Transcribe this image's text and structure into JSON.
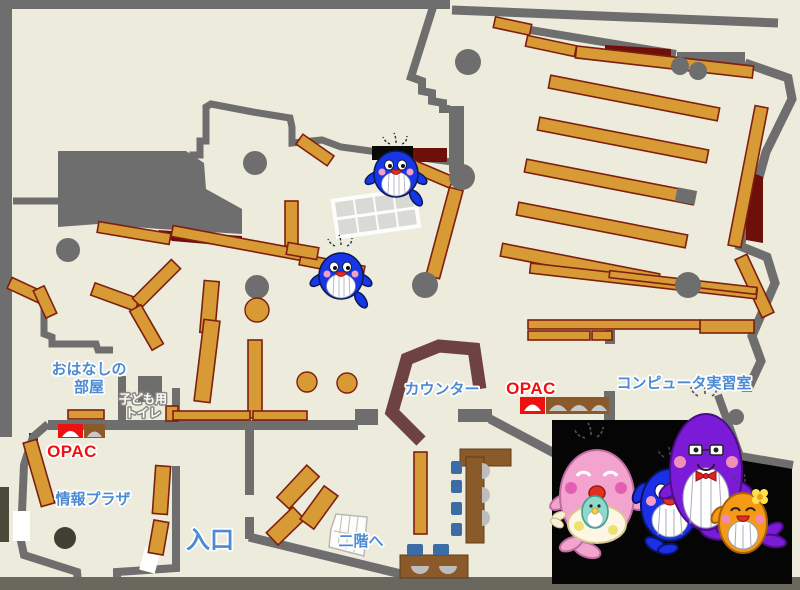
{
  "map": {
    "labels": {
      "story_room_line1": "おはなしの",
      "story_room_line2": "部屋",
      "kids_toilet_line1": "子ども用",
      "kids_toilet_line2": "トイレ",
      "opac_left": "OPAC",
      "info_plaza": "情報プラザ",
      "entrance": "入口",
      "to_second_floor": "二階へ",
      "counter": "カウンター",
      "opac_center": "OPAC",
      "computer_room": "コンピュータ実習室"
    },
    "colors": {
      "floor": "#ECEBDC",
      "wall": "#6E6E6E",
      "shelf": "#D79A35",
      "shelf_border": "#7E1F10",
      "dark_red": "#6E0F0A",
      "counter_brown": "#6F4242",
      "label_blue": "#4C8BD4",
      "label_red": "#EE1111",
      "chair_blue": "#3B6CA6",
      "desk_brown": "#8A5A2A",
      "photo_background": "#050505",
      "mascot_pink": "#F2A3CE",
      "mascot_blue": "#1A2FE6",
      "mascot_purple": "#7B1BD8",
      "mascot_orange": "#F49A16"
    },
    "mascots": {
      "small_map_whales": 2,
      "family_photo": [
        "pink mother whale",
        "blue child whale",
        "purple father whale",
        "orange child whale"
      ]
    }
  }
}
